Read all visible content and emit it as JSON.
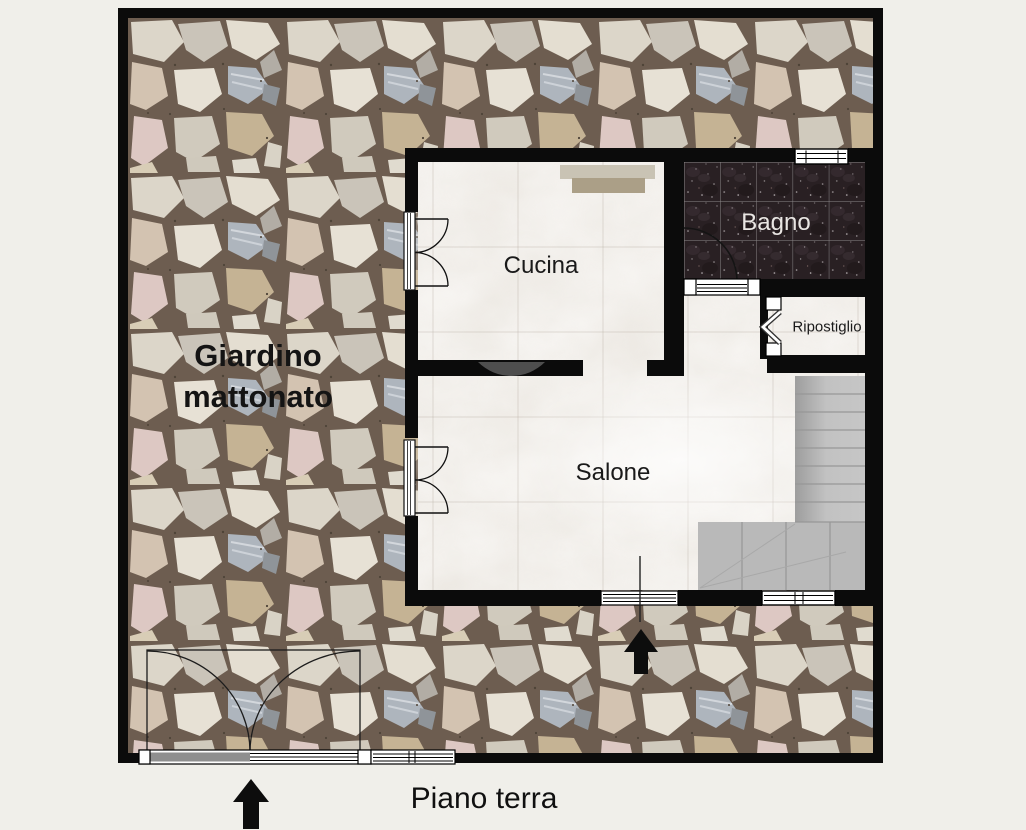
{
  "caption": "Piano terra",
  "garden": {
    "label": "Giardino mattonato"
  },
  "rooms": {
    "cucina": {
      "label": "Cucina"
    },
    "bagno": {
      "label": "Bagno"
    },
    "ripostiglio": {
      "label": "Ripostiglio"
    },
    "salone": {
      "label": "Salone"
    }
  },
  "colors": {
    "page_background": "#f0efea",
    "wall": "#0b0b0b",
    "marble_floor": "#f7f5f2",
    "bagno_tile": "#292023",
    "stone_grout": "#6d5d50",
    "stairs": "#bdbdbd",
    "stairs_landing": "#b9b9b9",
    "counter": "#c9c3b4",
    "counter_dark": "#ab9f87",
    "arrow": "#0d0d0d",
    "gate_leaf": "#8f8f8f",
    "arch": "#4e4e4e"
  }
}
